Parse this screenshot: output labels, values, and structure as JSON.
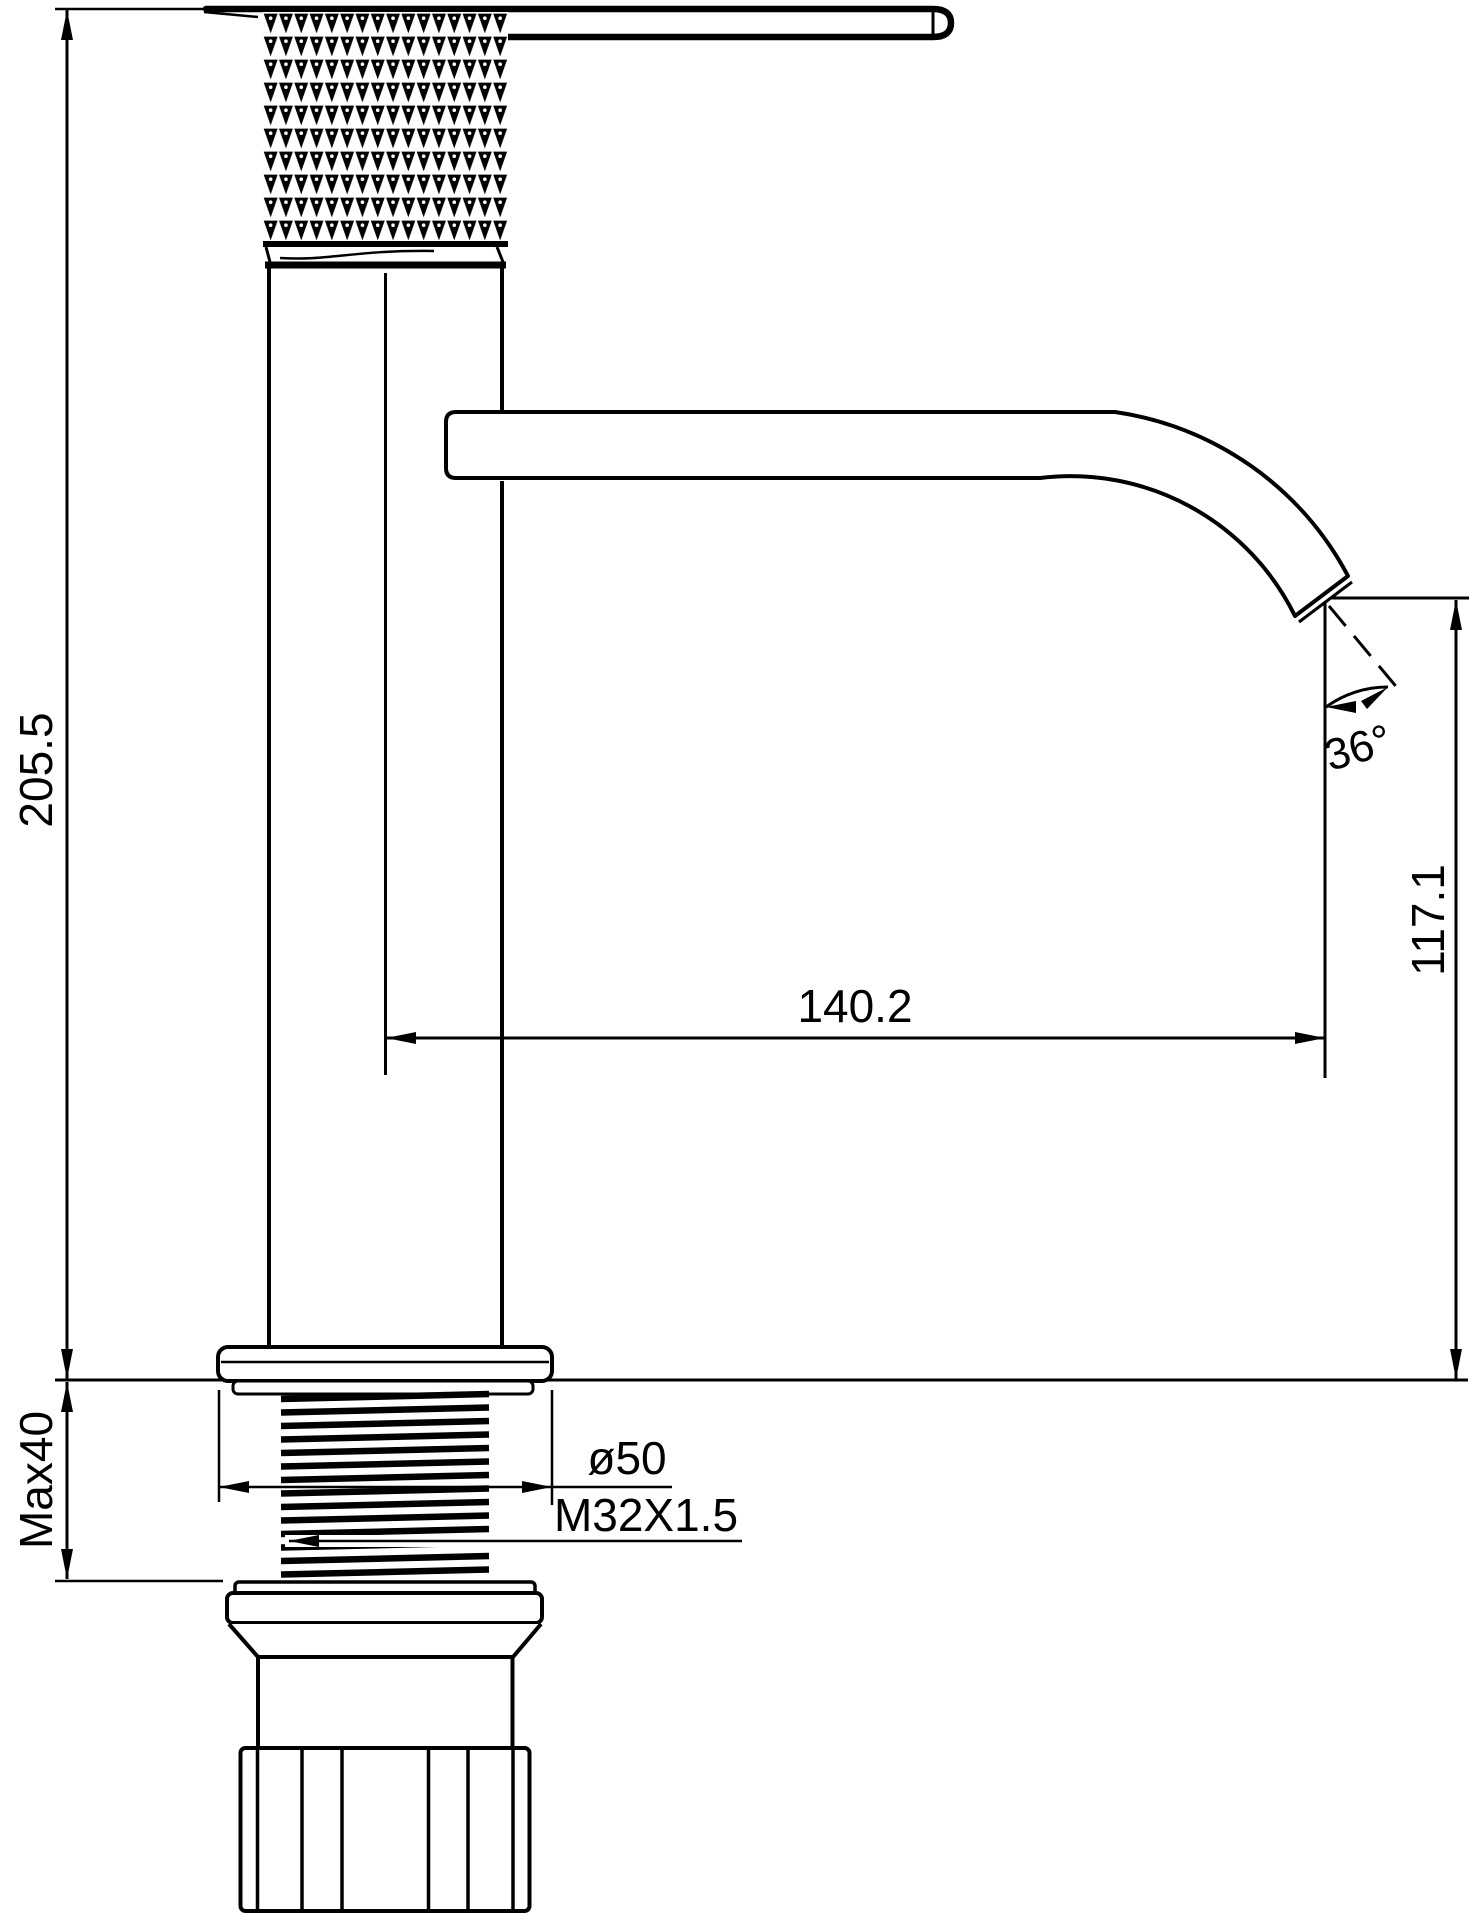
{
  "drawing": {
    "background": "#ffffff",
    "line_color": "#000000",
    "labels": {
      "overall_height": "205.5",
      "max_thickness": "Max40",
      "spout_reach": "140.2",
      "outlet_height": "117.1",
      "outlet_angle": "36°",
      "flange_diameter": "ø50",
      "thread_spec": "M32X1.5"
    }
  }
}
